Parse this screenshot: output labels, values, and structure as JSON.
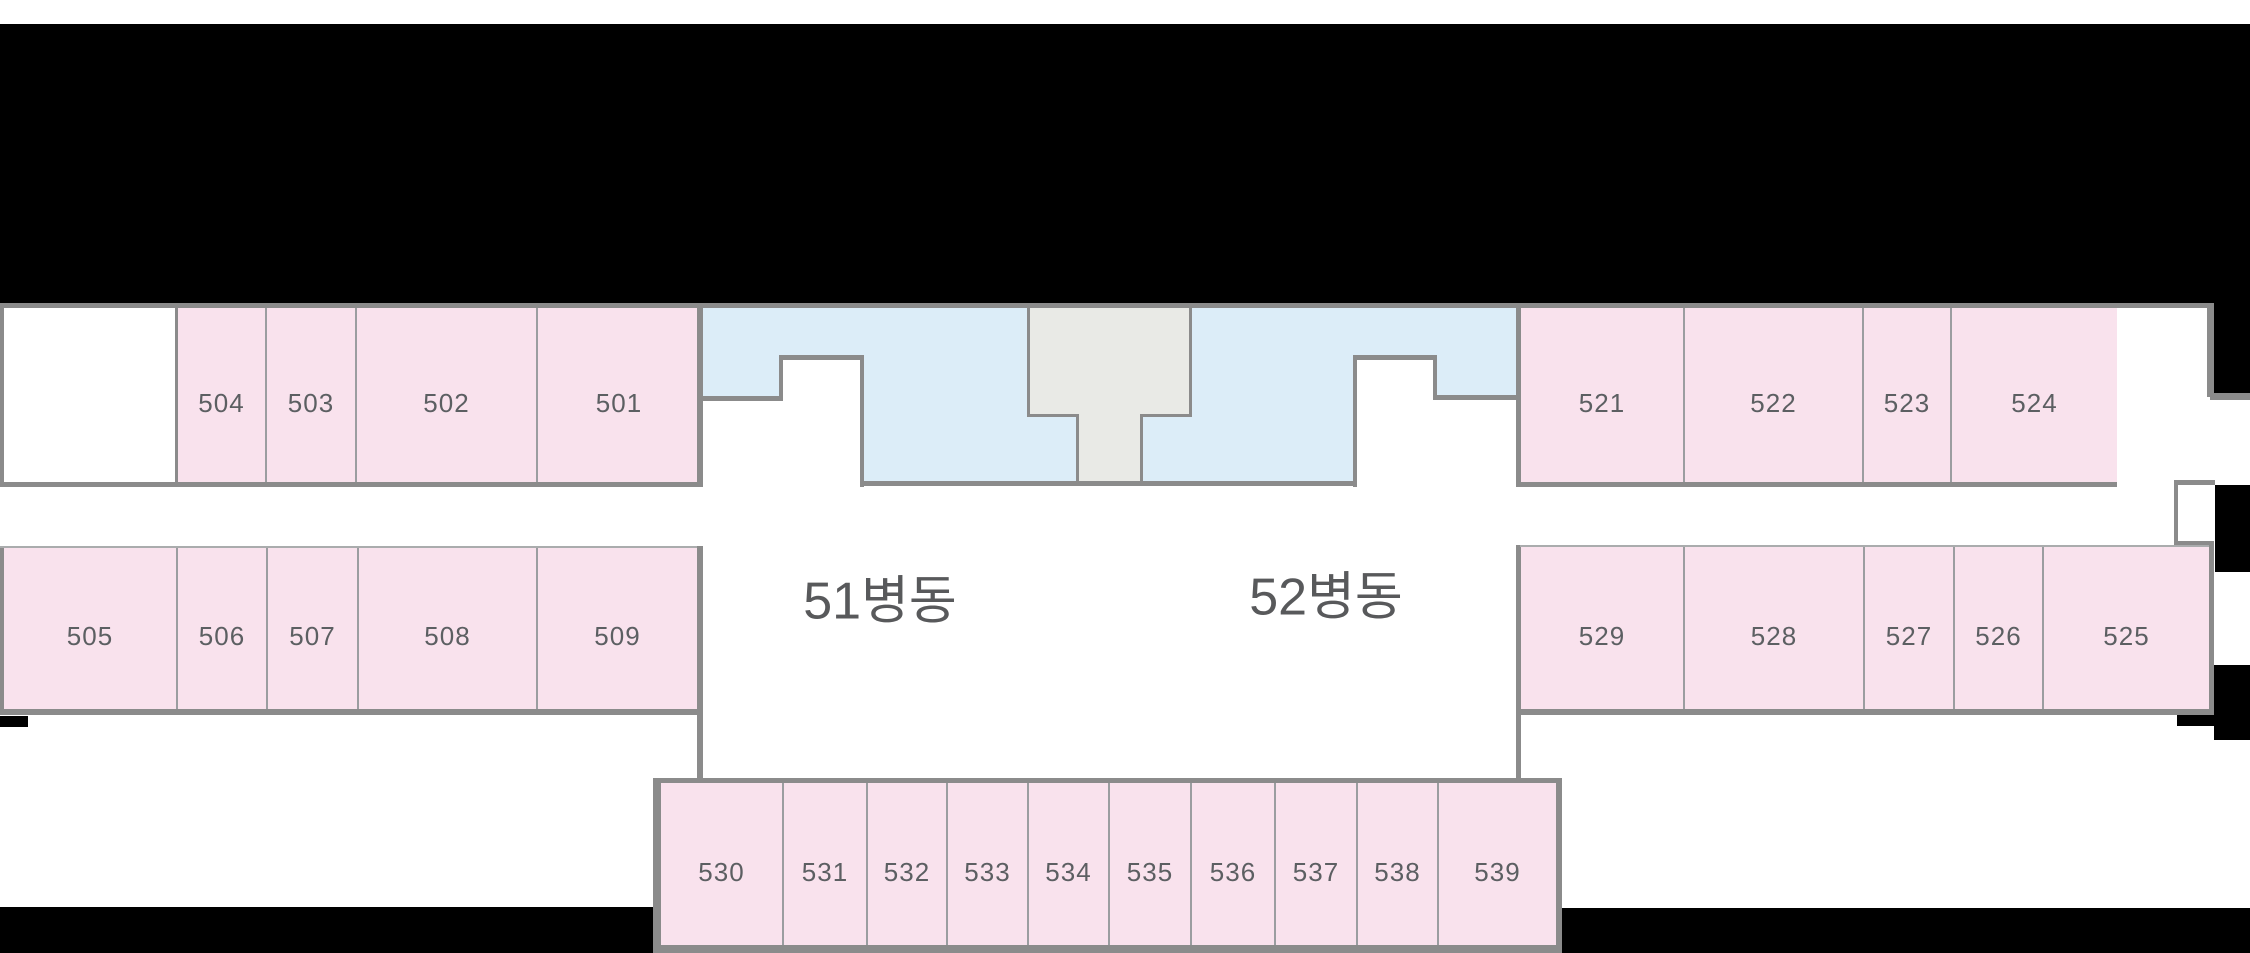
{
  "header": {
    "title": "본관 5층 입원병동 안내",
    "ward_info": [
      "51병동: 소화기내과, 혈액종양내과 병동",
      "52병동: 심장내과, 신장내과"
    ]
  },
  "floor_plan": {
    "ward_labels": [
      {
        "id": "ward-51",
        "text": "51병동",
        "cx": 880,
        "cy": 596
      },
      {
        "id": "ward-52",
        "text": "52병동",
        "cx": 1326,
        "cy": 592
      }
    ],
    "room_groups": [
      {
        "id": "top-left",
        "x": 178,
        "y": 308,
        "w": 522,
        "h": 174,
        "rooms": [
          {
            "label": "504",
            "w": 87
          },
          {
            "label": "503",
            "w": 90
          },
          {
            "label": "502",
            "w": 181
          },
          {
            "label": "501",
            "w": 164
          }
        ]
      },
      {
        "id": "top-right",
        "x": 1521,
        "y": 308,
        "w": 596,
        "h": 174,
        "rooms": [
          {
            "label": "521",
            "w": 162
          },
          {
            "label": "522",
            "w": 179
          },
          {
            "label": "523",
            "w": 88
          },
          {
            "label": "524",
            "w": 167
          }
        ]
      },
      {
        "id": "mid-left",
        "x": 4,
        "y": 548,
        "w": 693,
        "h": 161,
        "rooms": [
          {
            "label": "505",
            "w": 172
          },
          {
            "label": "506",
            "w": 90
          },
          {
            "label": "507",
            "w": 91
          },
          {
            "label": "508",
            "w": 179
          },
          {
            "label": "509",
            "w": 161
          }
        ]
      },
      {
        "id": "mid-right",
        "x": 1521,
        "y": 547,
        "w": 688,
        "h": 162,
        "rooms": [
          {
            "label": "529",
            "w": 162
          },
          {
            "label": "528",
            "w": 180
          },
          {
            "label": "527",
            "w": 90
          },
          {
            "label": "526",
            "w": 89
          },
          {
            "label": "525",
            "w": 167
          }
        ]
      },
      {
        "id": "bottom",
        "x": 661,
        "y": 783,
        "w": 895,
        "h": 162,
        "rooms": [
          {
            "label": "530",
            "w": 121
          },
          {
            "label": "531",
            "w": 84
          },
          {
            "label": "532",
            "w": 80
          },
          {
            "label": "533",
            "w": 81
          },
          {
            "label": "534",
            "w": 81
          },
          {
            "label": "535",
            "w": 82
          },
          {
            "label": "536",
            "w": 84
          },
          {
            "label": "537",
            "w": 82
          },
          {
            "label": "538",
            "w": 81
          },
          {
            "label": "539",
            "w": 119
          }
        ]
      }
    ]
  },
  "colors": {
    "room_fill": "#f9e2ed",
    "lobby_fill": "#dcedf8",
    "core_fill": "#e9eae6",
    "wall": "#8b8b8b",
    "background_black": "#000000",
    "page_white": "#ffffff",
    "header_text": "#6a6b6d",
    "ward_label_text": "#58595b",
    "room_number_text": "#5c5f62"
  }
}
